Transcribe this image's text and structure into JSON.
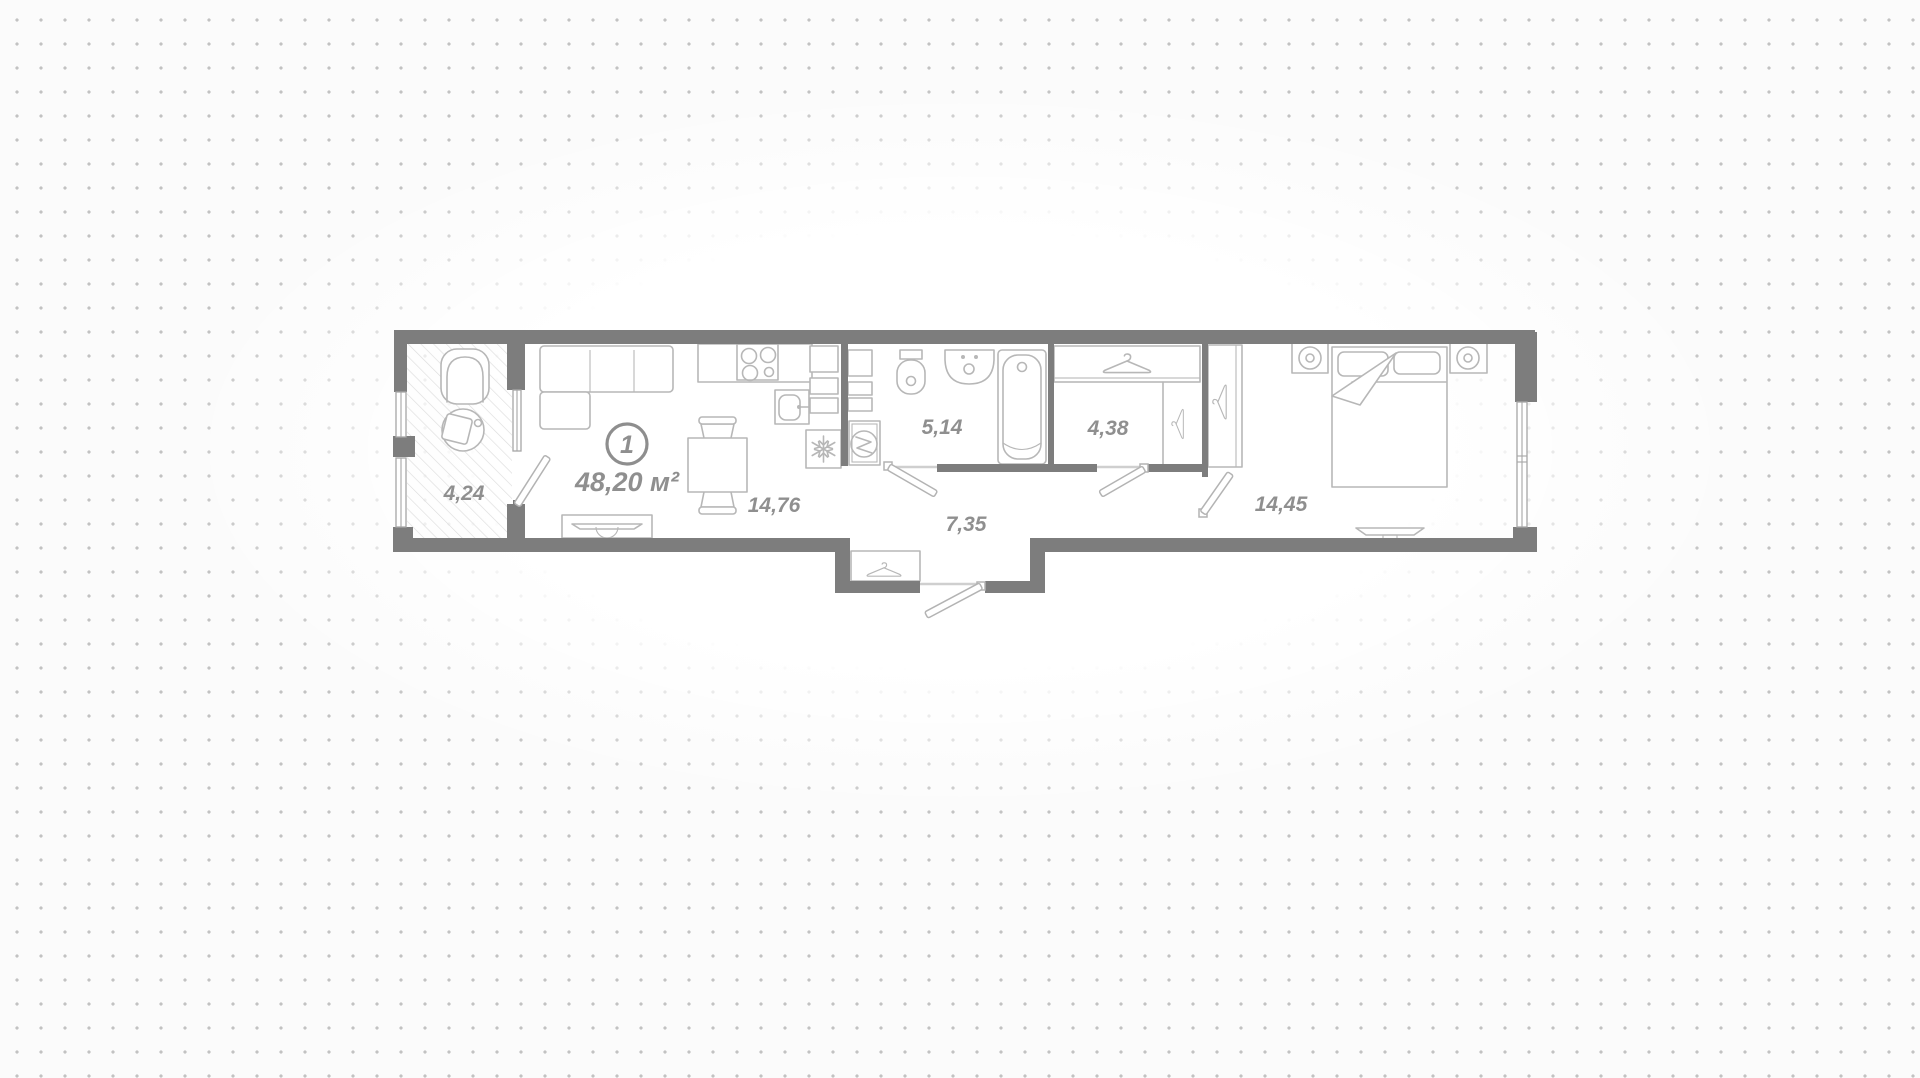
{
  "plan": {
    "unit": {
      "number": "1",
      "total_area": "48,20 м²"
    },
    "rooms": {
      "balcony": {
        "area": "4,24"
      },
      "kitchen_living": {
        "area": "14,76"
      },
      "bathroom": {
        "area": "5,14"
      },
      "hallway": {
        "area": "7,35"
      },
      "wardrobe": {
        "area": "4,38"
      },
      "bedroom": {
        "area": "14,45"
      }
    },
    "colors": {
      "wall": "#7d7d7d",
      "furn": "#b7b7b7",
      "label": "#8f8f8f",
      "hatch": "#dddddd",
      "dot": "#c2c2c2"
    }
  }
}
